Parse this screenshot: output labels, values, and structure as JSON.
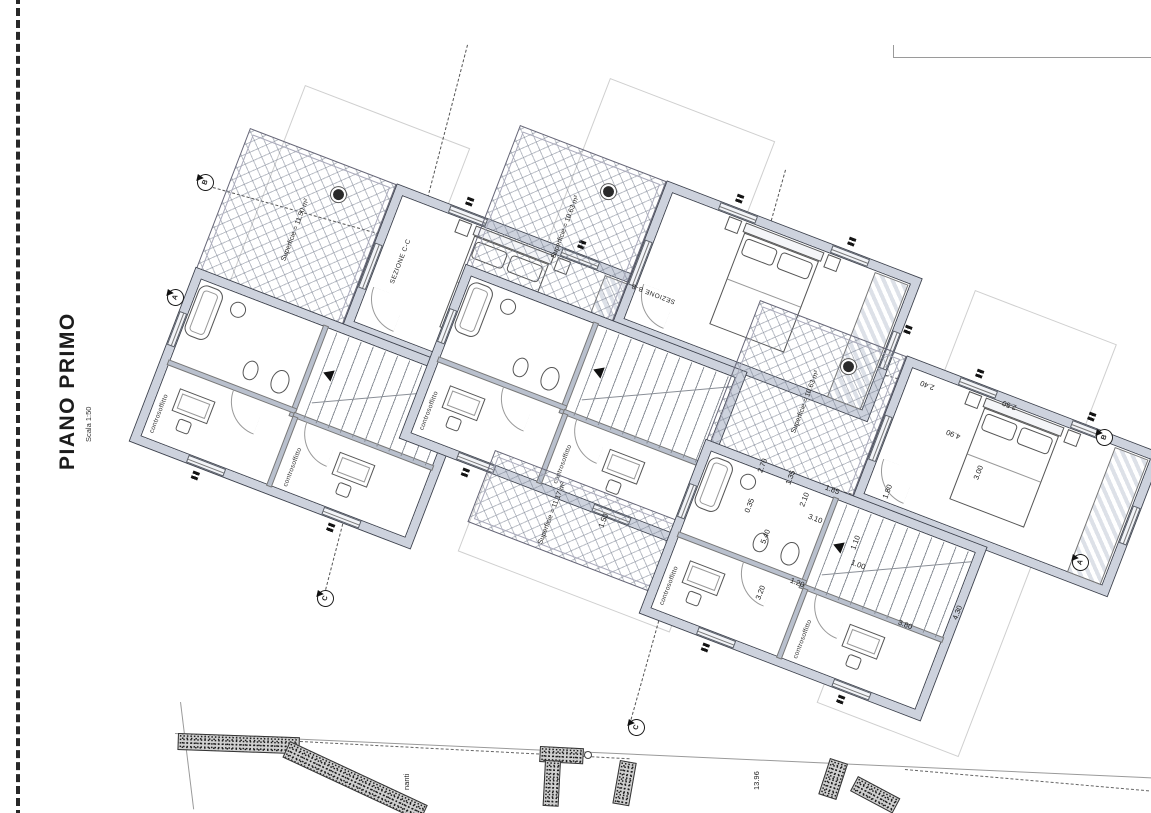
{
  "sheet": {
    "title": "PIANO PRIMO",
    "scale": "Scala 1:50"
  },
  "colors": {
    "paper": "#ffffff",
    "wall_fill": "#cdd2dd",
    "wall_line": "#3f4450",
    "hatch": "#78808f"
  },
  "terraces": {
    "t1": "Superficie = 11.50 m²",
    "t2": "Superficie = 10.63 m²",
    "t3": "Superficie = 11.17 m²",
    "t4": "Superficie = 10.63 m²"
  },
  "room_labels": {
    "ceiling": "controsoffitto"
  },
  "sections": {
    "cc": "SEZIONE C-C",
    "bb": "SEZIONE B-B",
    "m_a": "A",
    "m_b": "B",
    "m_c": "C"
  },
  "dims": [
    "2.40",
    "2.50",
    "4.90",
    "3.00",
    "1.80",
    "2.70",
    "0.35",
    "1.35",
    "2.10",
    "1.85",
    "3.10",
    "5.40",
    "1.10",
    "1.00",
    "3.20",
    "1.20",
    "3.80",
    "4.30",
    "1.50"
  ],
  "site": {
    "label": "nanti",
    "dim": "13.96"
  }
}
